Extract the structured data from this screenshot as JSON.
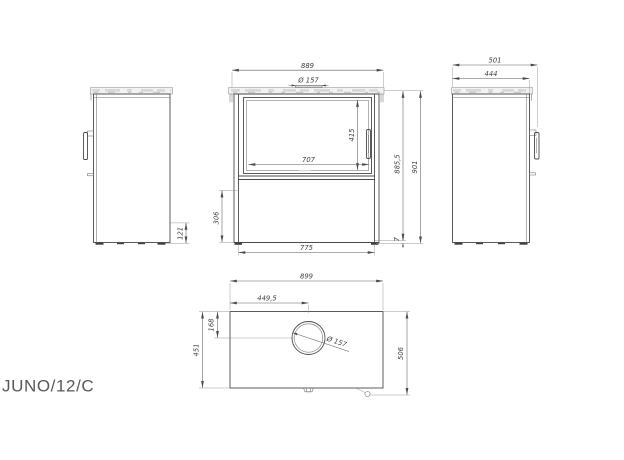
{
  "drawing": {
    "model_label": "JUNO/12/C",
    "line_color": "#4a4a4a",
    "dim_color": "#5a5a5a",
    "text_color": "#3d3d3d",
    "plate_fill": "#f2f2f2"
  },
  "front_view": {
    "total_width": "889",
    "flue_diameter": "Ø 157",
    "glass_height": "415",
    "glass_width": "707",
    "height_to_top": "885,5",
    "total_height": "901",
    "plinth_height": "306",
    "leg_span": "775",
    "floor_gap": "7"
  },
  "left_view": {
    "lower_section_height": "121"
  },
  "right_view": {
    "total_depth": "501",
    "body_depth": "444"
  },
  "top_view": {
    "total_width": "899",
    "flue_offset_x": "449,5",
    "flue_offset_y": "168",
    "body_depth": "451",
    "total_depth": "506",
    "flue_diameter": "Ø 157"
  }
}
